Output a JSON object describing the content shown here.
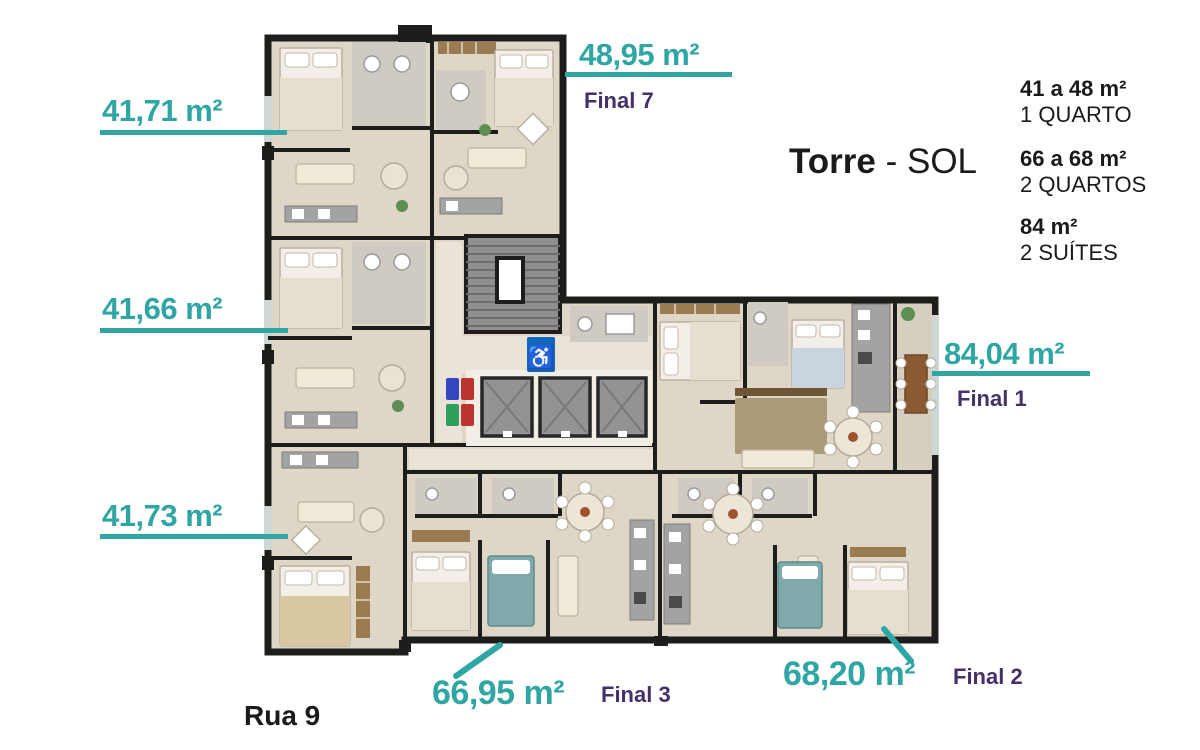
{
  "title": {
    "name": "Torre",
    "suffix": "- SOL"
  },
  "street": {
    "label": "Rua 9"
  },
  "legend": [
    {
      "area": "41 a 48 m²",
      "type": "1 QUARTO"
    },
    {
      "area": "66 a 68 m²",
      "type": "2 QUARTOS"
    },
    {
      "area": "84 m²",
      "type": "2 SUÍTES"
    }
  ],
  "units": {
    "top_left": {
      "area": "41,71 m²"
    },
    "top_right": {
      "area": "48,95 m²",
      "final": "Final 7"
    },
    "middle_left": {
      "area": "41,66 m²"
    },
    "bottom_left": {
      "area": "41,73 m²"
    },
    "right": {
      "area": "84,04 m²",
      "final": "Final 1"
    },
    "bottom_center": {
      "area": "66,95 m²",
      "final": "Final 3"
    },
    "bottom_right": {
      "area": "68,20 m²",
      "final": "Final 2"
    }
  },
  "plan": {
    "accessibility_icon": "♿"
  },
  "colors": {
    "accent_teal": "#2fa6a4",
    "accent_purple": "#463069",
    "wall_black": "#1d1d1b",
    "floor_beige": "#ded6c7",
    "stairs_gray": "#8f8f8f",
    "accessibility_blue": "#1166bb",
    "text_black": "#1a1a1a"
  }
}
